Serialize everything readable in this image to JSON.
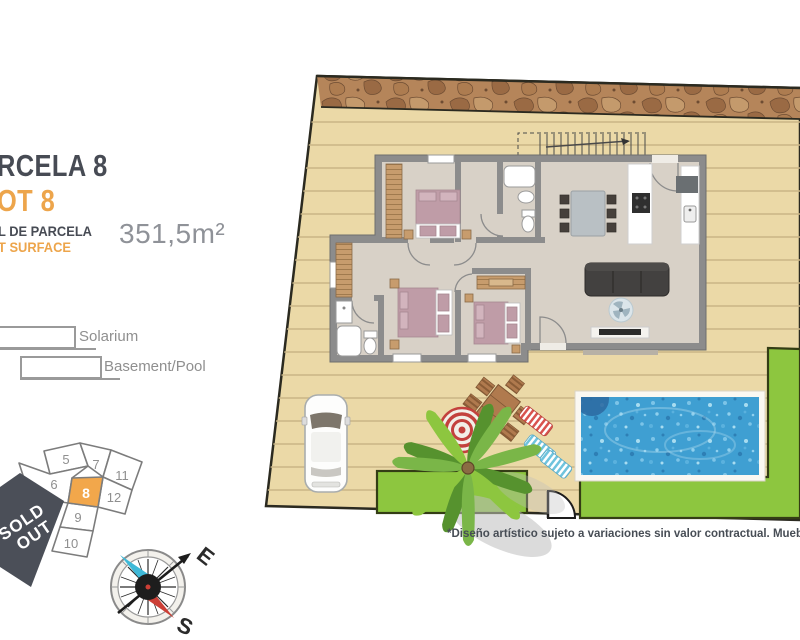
{
  "title": {
    "parcela_fragment": "RCELA 8",
    "plot_fragment": "OT 8"
  },
  "surface": {
    "label_es_fragment": "L DE PARCELA",
    "label_en_fragment": "T SURFACE",
    "value": "351,5m²"
  },
  "legend": {
    "items": [
      {
        "label": "Solarium"
      },
      {
        "label": "Basement/Pool"
      }
    ]
  },
  "site_map": {
    "lots": [
      {
        "number": "5"
      },
      {
        "number": "7"
      },
      {
        "number": "11"
      },
      {
        "number": "6"
      },
      {
        "number": "8",
        "highlighted": true
      },
      {
        "number": "12"
      },
      {
        "number": "9"
      },
      {
        "number": "10"
      }
    ],
    "sold_out_line1": "SOLD",
    "sold_out_line2": "OUT"
  },
  "compass": {
    "east": "E",
    "south": "S"
  },
  "disclaimer": "*Diseño artístico sujeto a variaciones sin valor contractual. Muebles no incluidos",
  "colors": {
    "accent_orange": "#EDA54B",
    "title_dark": "#474B54",
    "deck": "#EBD9A7",
    "stone_band": "#B5855A",
    "grass": "#8DC63F",
    "pool_water": "#3F9FD2",
    "wall_gray": "#8C8C8C",
    "floor": "#D8D1C7",
    "bed_mauve": "#BF9CA7",
    "sold_out_bg": "#4B4F58",
    "lot_highlight": "#F2A74B",
    "value_gray": "#8F9298"
  }
}
